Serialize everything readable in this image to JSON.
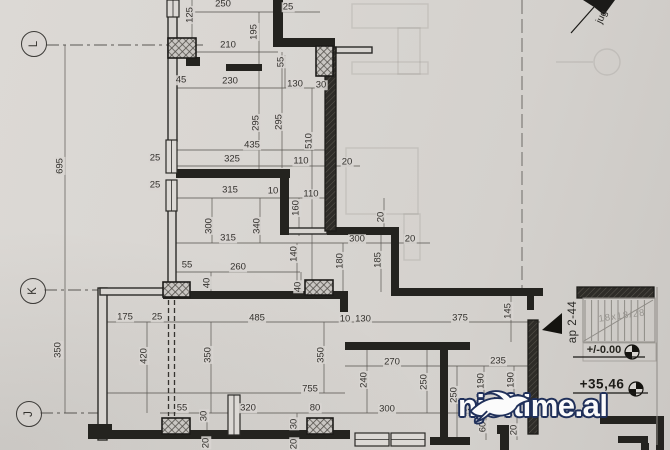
{
  "document": {
    "type": "architectural floor plan photo",
    "colors": {
      "paper": "#d8d5d1",
      "ink": "#24231f",
      "dim_line": "#5d5a55",
      "watermark_navy": "#20305a",
      "watermark_white": "#fbfbfb"
    }
  },
  "grid_markers": [
    {
      "label": "L"
    },
    {
      "label": "K"
    },
    {
      "label": "J"
    }
  ],
  "annotations": {
    "apartment_label": "ap 2-44",
    "stair_note": "18x18/28",
    "level_ground": "+/-0.00",
    "level_roof": "+35,46",
    "orientation_label": "jug"
  },
  "watermark": {
    "text": "njoftime.al",
    "logo": "swallow-bird-icon"
  },
  "dimensions": [
    {
      "text": "250",
      "x": 223,
      "y": 4,
      "rot": false
    },
    {
      "text": "25",
      "x": 288,
      "y": 7,
      "rot": false
    },
    {
      "text": "125",
      "x": 190,
      "y": 15,
      "rot": true
    },
    {
      "text": "195",
      "x": 254,
      "y": 32,
      "rot": true
    },
    {
      "text": "210",
      "x": 228,
      "y": 45,
      "rot": false
    },
    {
      "text": "55",
      "x": 281,
      "y": 62,
      "rot": true
    },
    {
      "text": "45",
      "x": 181,
      "y": 80,
      "rot": false
    },
    {
      "text": "230",
      "x": 230,
      "y": 81,
      "rot": false
    },
    {
      "text": "130",
      "x": 295,
      "y": 84,
      "rot": false
    },
    {
      "text": "30",
      "x": 321,
      "y": 85,
      "rot": false
    },
    {
      "text": "295",
      "x": 256,
      "y": 123,
      "rot": true
    },
    {
      "text": "295",
      "x": 279,
      "y": 122,
      "rot": true
    },
    {
      "text": "510",
      "x": 309,
      "y": 141,
      "rot": true
    },
    {
      "text": "435",
      "x": 252,
      "y": 145,
      "rot": false
    },
    {
      "text": "325",
      "x": 232,
      "y": 159,
      "rot": false
    },
    {
      "text": "110",
      "x": 301,
      "y": 161,
      "rot": false
    },
    {
      "text": "20",
      "x": 347,
      "y": 162,
      "rot": false
    },
    {
      "text": "25",
      "x": 155,
      "y": 158,
      "rot": false
    },
    {
      "text": "25",
      "x": 155,
      "y": 185,
      "rot": false
    },
    {
      "text": "315",
      "x": 230,
      "y": 190,
      "rot": false
    },
    {
      "text": "10",
      "x": 273,
      "y": 191,
      "rot": false
    },
    {
      "text": "110",
      "x": 311,
      "y": 194,
      "rot": false
    },
    {
      "text": "160",
      "x": 296,
      "y": 208,
      "rot": true
    },
    {
      "text": "20",
      "x": 381,
      "y": 217,
      "rot": true
    },
    {
      "text": "300",
      "x": 209,
      "y": 226,
      "rot": true
    },
    {
      "text": "340",
      "x": 257,
      "y": 226,
      "rot": true
    },
    {
      "text": "315",
      "x": 228,
      "y": 238,
      "rot": false
    },
    {
      "text": "300",
      "x": 357,
      "y": 239,
      "rot": false
    },
    {
      "text": "20",
      "x": 410,
      "y": 239,
      "rot": false
    },
    {
      "text": "140",
      "x": 294,
      "y": 254,
      "rot": true
    },
    {
      "text": "185",
      "x": 378,
      "y": 260,
      "rot": true
    },
    {
      "text": "180",
      "x": 340,
      "y": 261,
      "rot": true
    },
    {
      "text": "55",
      "x": 187,
      "y": 265,
      "rot": false
    },
    {
      "text": "260",
      "x": 238,
      "y": 267,
      "rot": false
    },
    {
      "text": "40",
      "x": 207,
      "y": 283,
      "rot": true
    },
    {
      "text": "40",
      "x": 298,
      "y": 287,
      "rot": true
    },
    {
      "text": "695",
      "x": 60,
      "y": 166,
      "rot": true
    },
    {
      "text": "350",
      "x": 58,
      "y": 350,
      "rot": true
    },
    {
      "text": "175",
      "x": 125,
      "y": 317,
      "rot": false
    },
    {
      "text": "25",
      "x": 157,
      "y": 317,
      "rot": false
    },
    {
      "text": "485",
      "x": 257,
      "y": 318,
      "rot": false
    },
    {
      "text": "10",
      "x": 345,
      "y": 319,
      "rot": false
    },
    {
      "text": "130",
      "x": 363,
      "y": 319,
      "rot": false
    },
    {
      "text": "375",
      "x": 460,
      "y": 318,
      "rot": false
    },
    {
      "text": "145",
      "x": 508,
      "y": 311,
      "rot": true
    },
    {
      "text": "420",
      "x": 144,
      "y": 356,
      "rot": true
    },
    {
      "text": "350",
      "x": 208,
      "y": 355,
      "rot": true
    },
    {
      "text": "350",
      "x": 321,
      "y": 355,
      "rot": true
    },
    {
      "text": "270",
      "x": 392,
      "y": 362,
      "rot": false
    },
    {
      "text": "235",
      "x": 498,
      "y": 361,
      "rot": false
    },
    {
      "text": "240",
      "x": 364,
      "y": 380,
      "rot": true
    },
    {
      "text": "250",
      "x": 424,
      "y": 382,
      "rot": true
    },
    {
      "text": "190",
      "x": 481,
      "y": 381,
      "rot": true
    },
    {
      "text": "190",
      "x": 511,
      "y": 380,
      "rot": true
    },
    {
      "text": "755",
      "x": 310,
      "y": 389,
      "rot": false
    },
    {
      "text": "250",
      "x": 454,
      "y": 395,
      "rot": true
    },
    {
      "text": "105",
      "x": 500,
      "y": 401,
      "rot": false
    },
    {
      "text": "55",
      "x": 182,
      "y": 408,
      "rot": false
    },
    {
      "text": "320",
      "x": 248,
      "y": 408,
      "rot": false
    },
    {
      "text": "80",
      "x": 315,
      "y": 408,
      "rot": false
    },
    {
      "text": "300",
      "x": 387,
      "y": 409,
      "rot": false
    },
    {
      "text": "130",
      "x": 470,
      "y": 408,
      "rot": false
    },
    {
      "text": "30",
      "x": 204,
      "y": 416,
      "rot": true
    },
    {
      "text": "30",
      "x": 294,
      "y": 424,
      "rot": true
    },
    {
      "text": "60",
      "x": 483,
      "y": 427,
      "rot": true
    },
    {
      "text": "20",
      "x": 206,
      "y": 443,
      "rot": true
    },
    {
      "text": "20",
      "x": 294,
      "y": 444,
      "rot": true
    },
    {
      "text": "20",
      "x": 514,
      "y": 430,
      "rot": true
    }
  ]
}
